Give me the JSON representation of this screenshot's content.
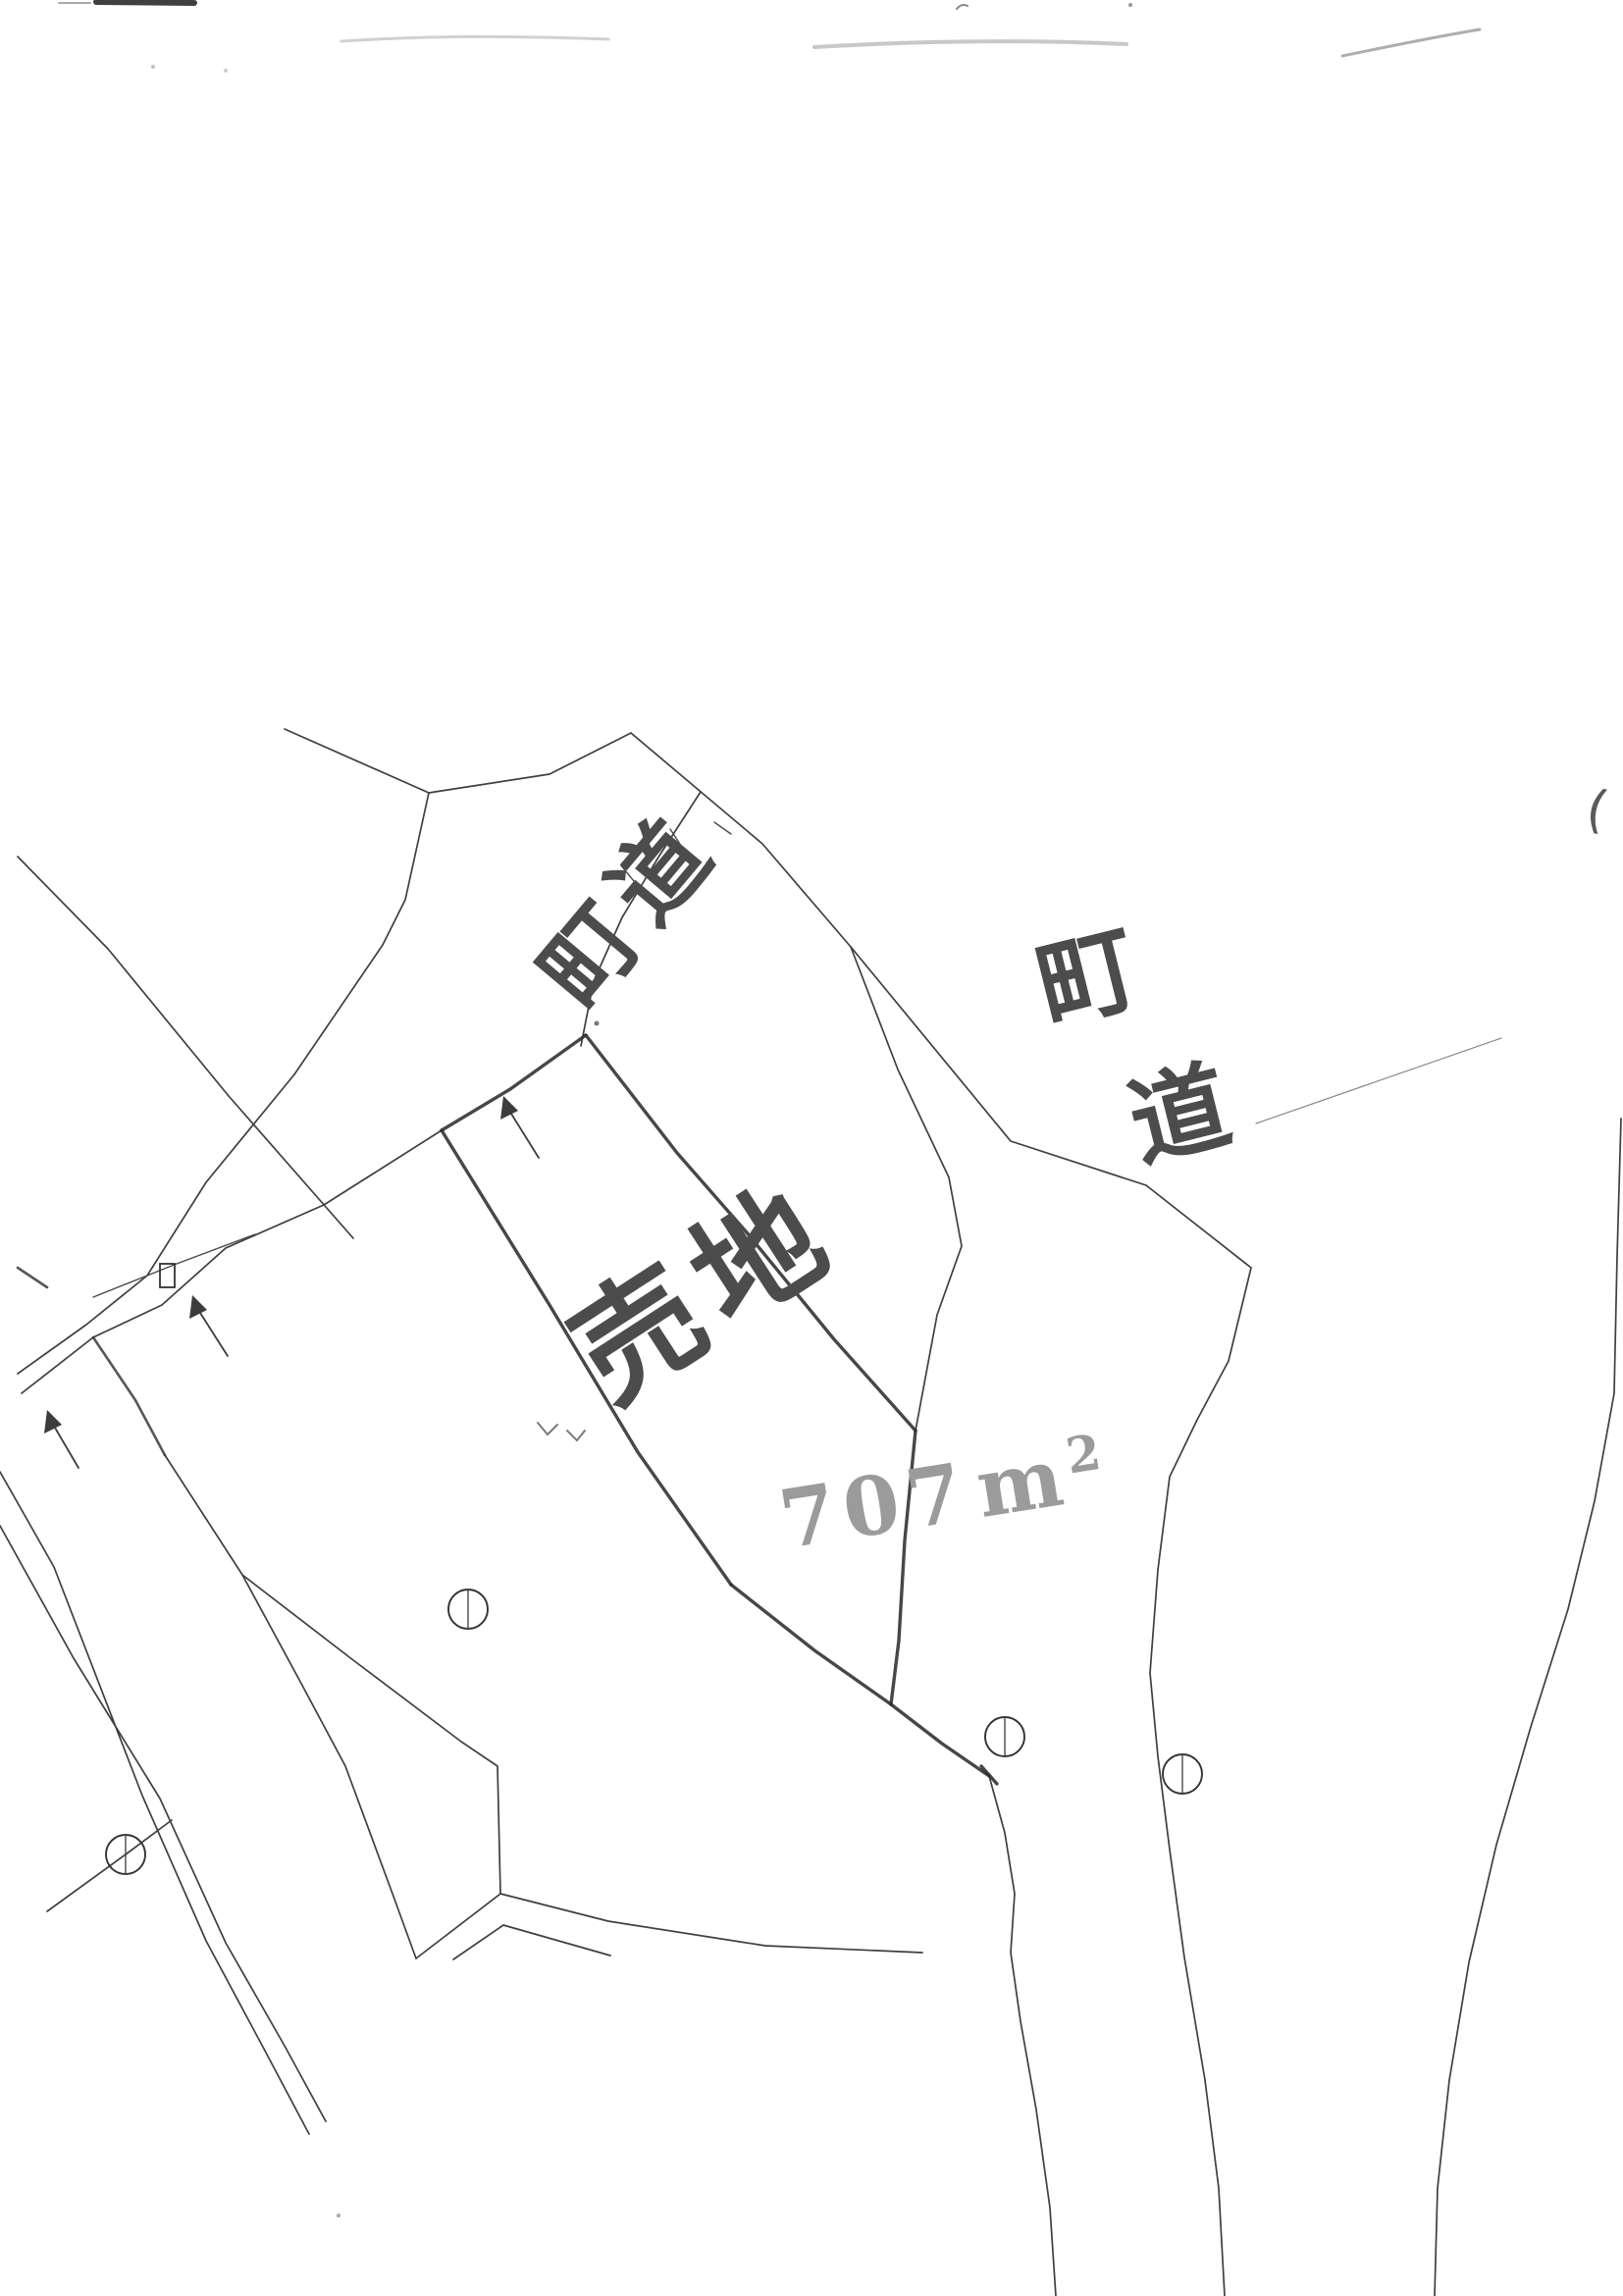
{
  "labels": {
    "road_top": "町道",
    "road_right_char1": "町",
    "road_right_char2": "道",
    "parcel": "売地",
    "area_value": "707",
    "area_unit": "m",
    "area_exponent": "2",
    "paren_mark": "("
  },
  "symbols": {
    "circle_survey_markers": 4,
    "boundary_arrows": 3,
    "small_square_symbol": 1
  },
  "colors": {
    "paper": "#ffffff",
    "printed_line": "#3f3f3f",
    "pencil_trace": "#2d2d2d",
    "pencil_area_text": "#9b9b9b"
  }
}
